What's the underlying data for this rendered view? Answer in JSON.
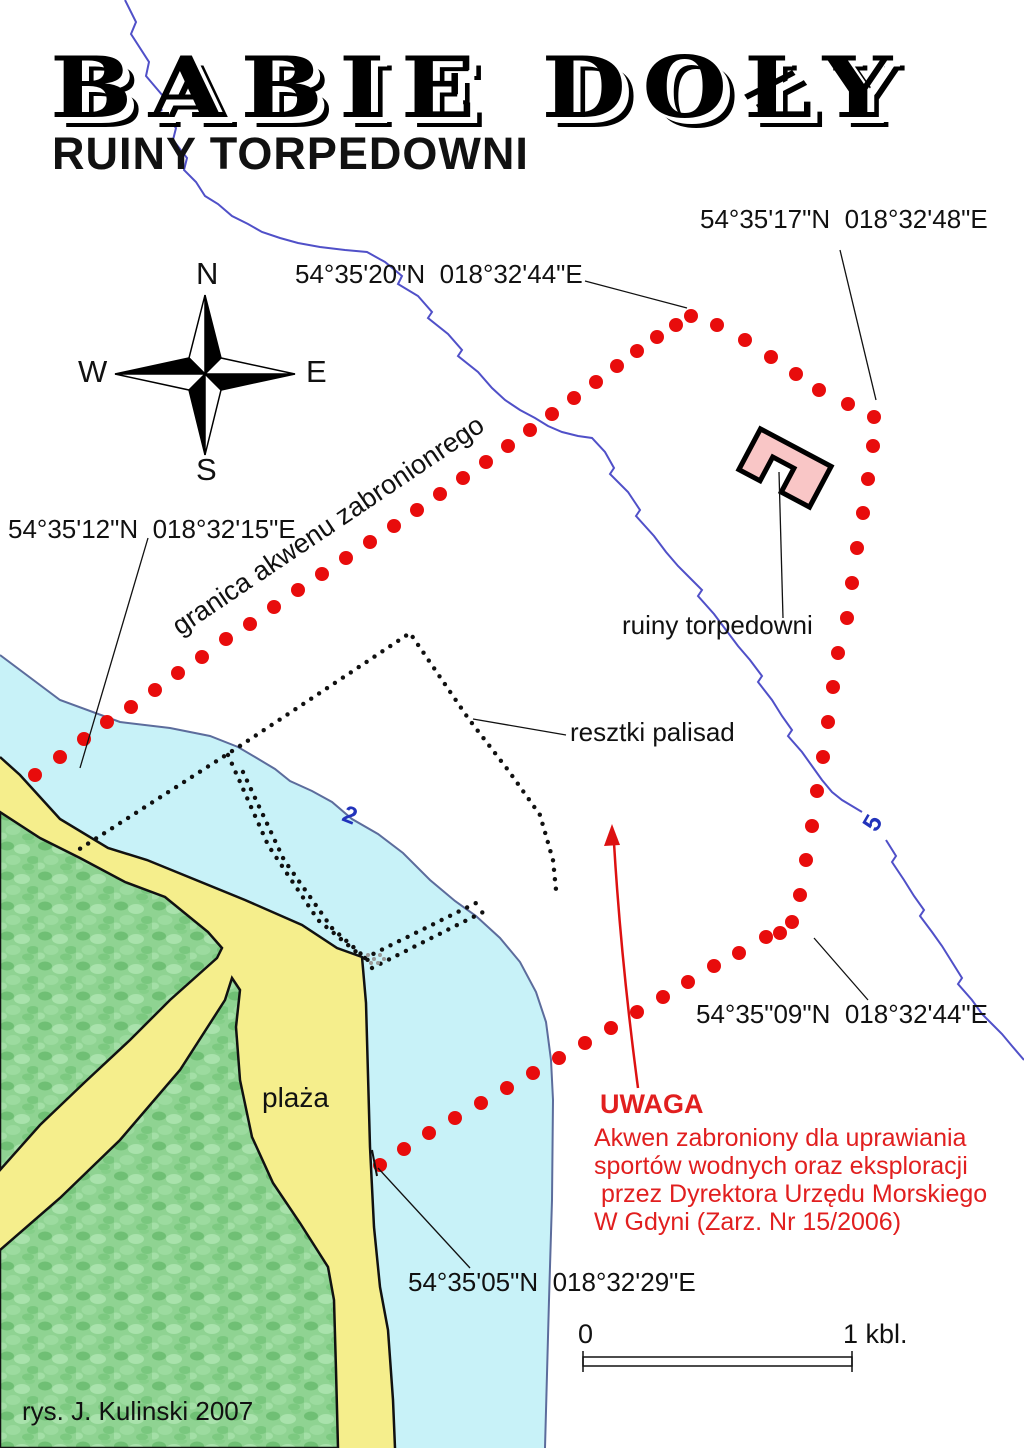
{
  "title": "BABIE DOŁY",
  "subtitle": "RUINY TORPEDOWNI",
  "credit": "rys. J. Kulinski 2007",
  "compass": {
    "north": "N",
    "east": "E",
    "south": "S",
    "west": "W"
  },
  "coordinates": {
    "top_right": "54°35'17\"N  018°32'48\"E",
    "top": "54°35'20\"N  018°32'44\"E",
    "left": "54°35'12\"N  018°32'15\"E",
    "right": "54°35\"09\"N  018°32'44\"E",
    "bottom": "54°35'05\"N  018°32'29\"E"
  },
  "labels": {
    "boundary": "granica akwenu zabronionrego",
    "ruins": "ruiny torpedowni",
    "palisade": "resztki palisad",
    "beach": "plaża",
    "depth_2m": "2",
    "depth_5m": "5"
  },
  "warning": {
    "heading": "UWAGA",
    "lines": [
      "Akwen zabroniony dla uprawiania",
      "sportów wodnych oraz eksploracji",
      " przez Dyrektora Urzędu Morskiego",
      "W Gdyni (Zarz. Nr 15/2006)"
    ]
  },
  "scale_bar": {
    "start": "0",
    "end": "1 kbl."
  },
  "colors": {
    "shallow_water": "#c8f2f8",
    "beach": "#f5ee8c",
    "land_green": "#8fd392",
    "building_fill": "#f9c6c6",
    "restricted_dots": "#e80c0c",
    "warning_text": "#e11f1f",
    "contour_2m": "#5c6c9c",
    "contour_5m": "#5050c8",
    "depth_label": "#2233bb"
  }
}
